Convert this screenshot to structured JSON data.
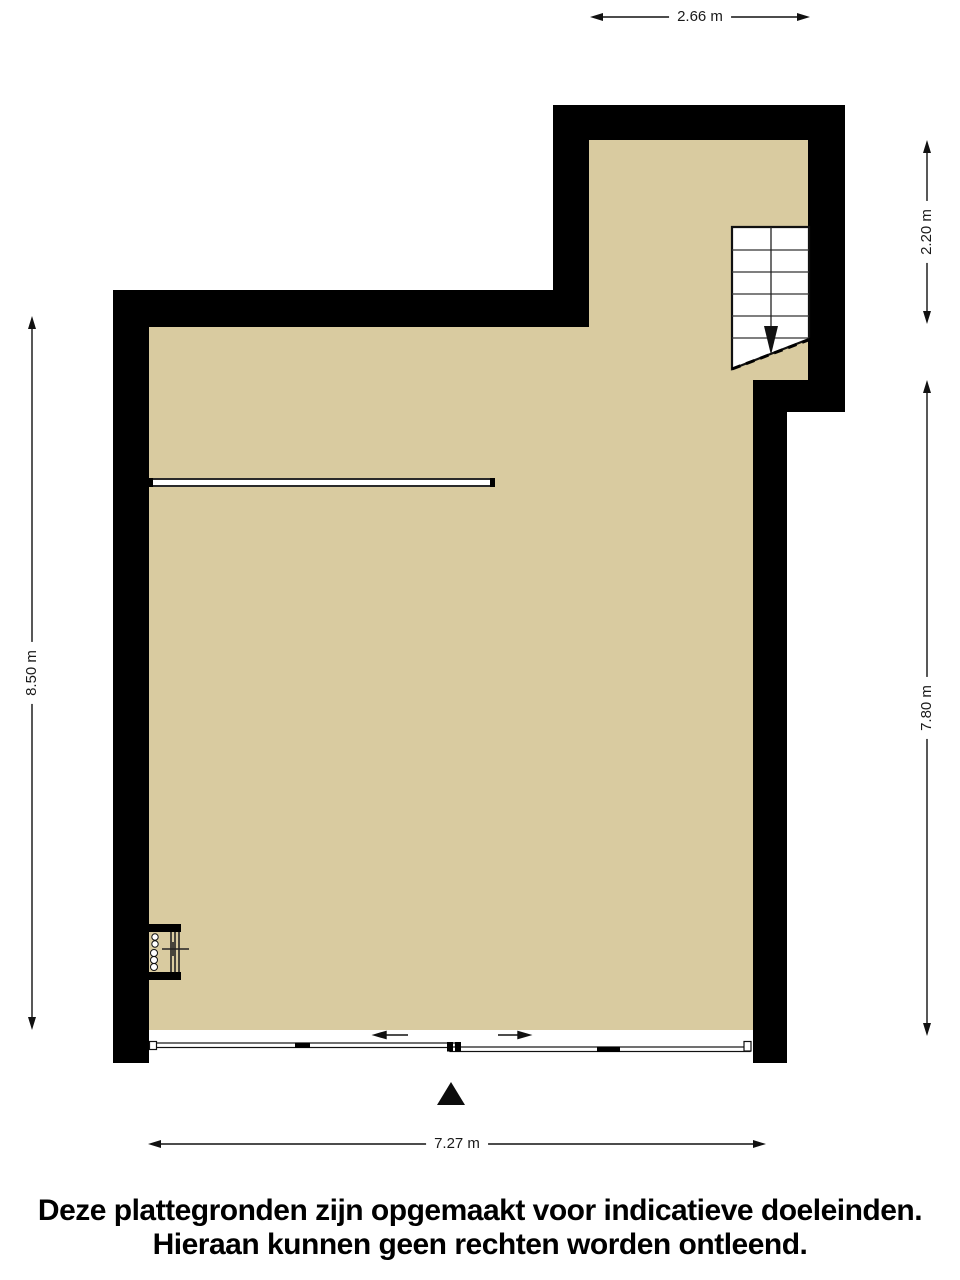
{
  "plan": {
    "dimensions": {
      "top": "2.66 m",
      "right_upper": "2.20 m",
      "right_lower": "7.80 m",
      "left": "8.50 m",
      "bottom": "7.27 m"
    },
    "colors": {
      "floor": "#d9cba0",
      "wall": "#000000",
      "background": "#ffffff"
    },
    "icons": {
      "stairs_walkline": "arrow-down",
      "north_indicator": "filled-triangle-up",
      "door_slide_left": "arrow-left",
      "door_slide_right": "arrow-right"
    }
  },
  "disclaimer": {
    "line1": "Deze plattegronden zijn opgemaakt voor indicatieve doeleinden.",
    "line2": "Hieraan kunnen geen rechten worden ontleend."
  }
}
